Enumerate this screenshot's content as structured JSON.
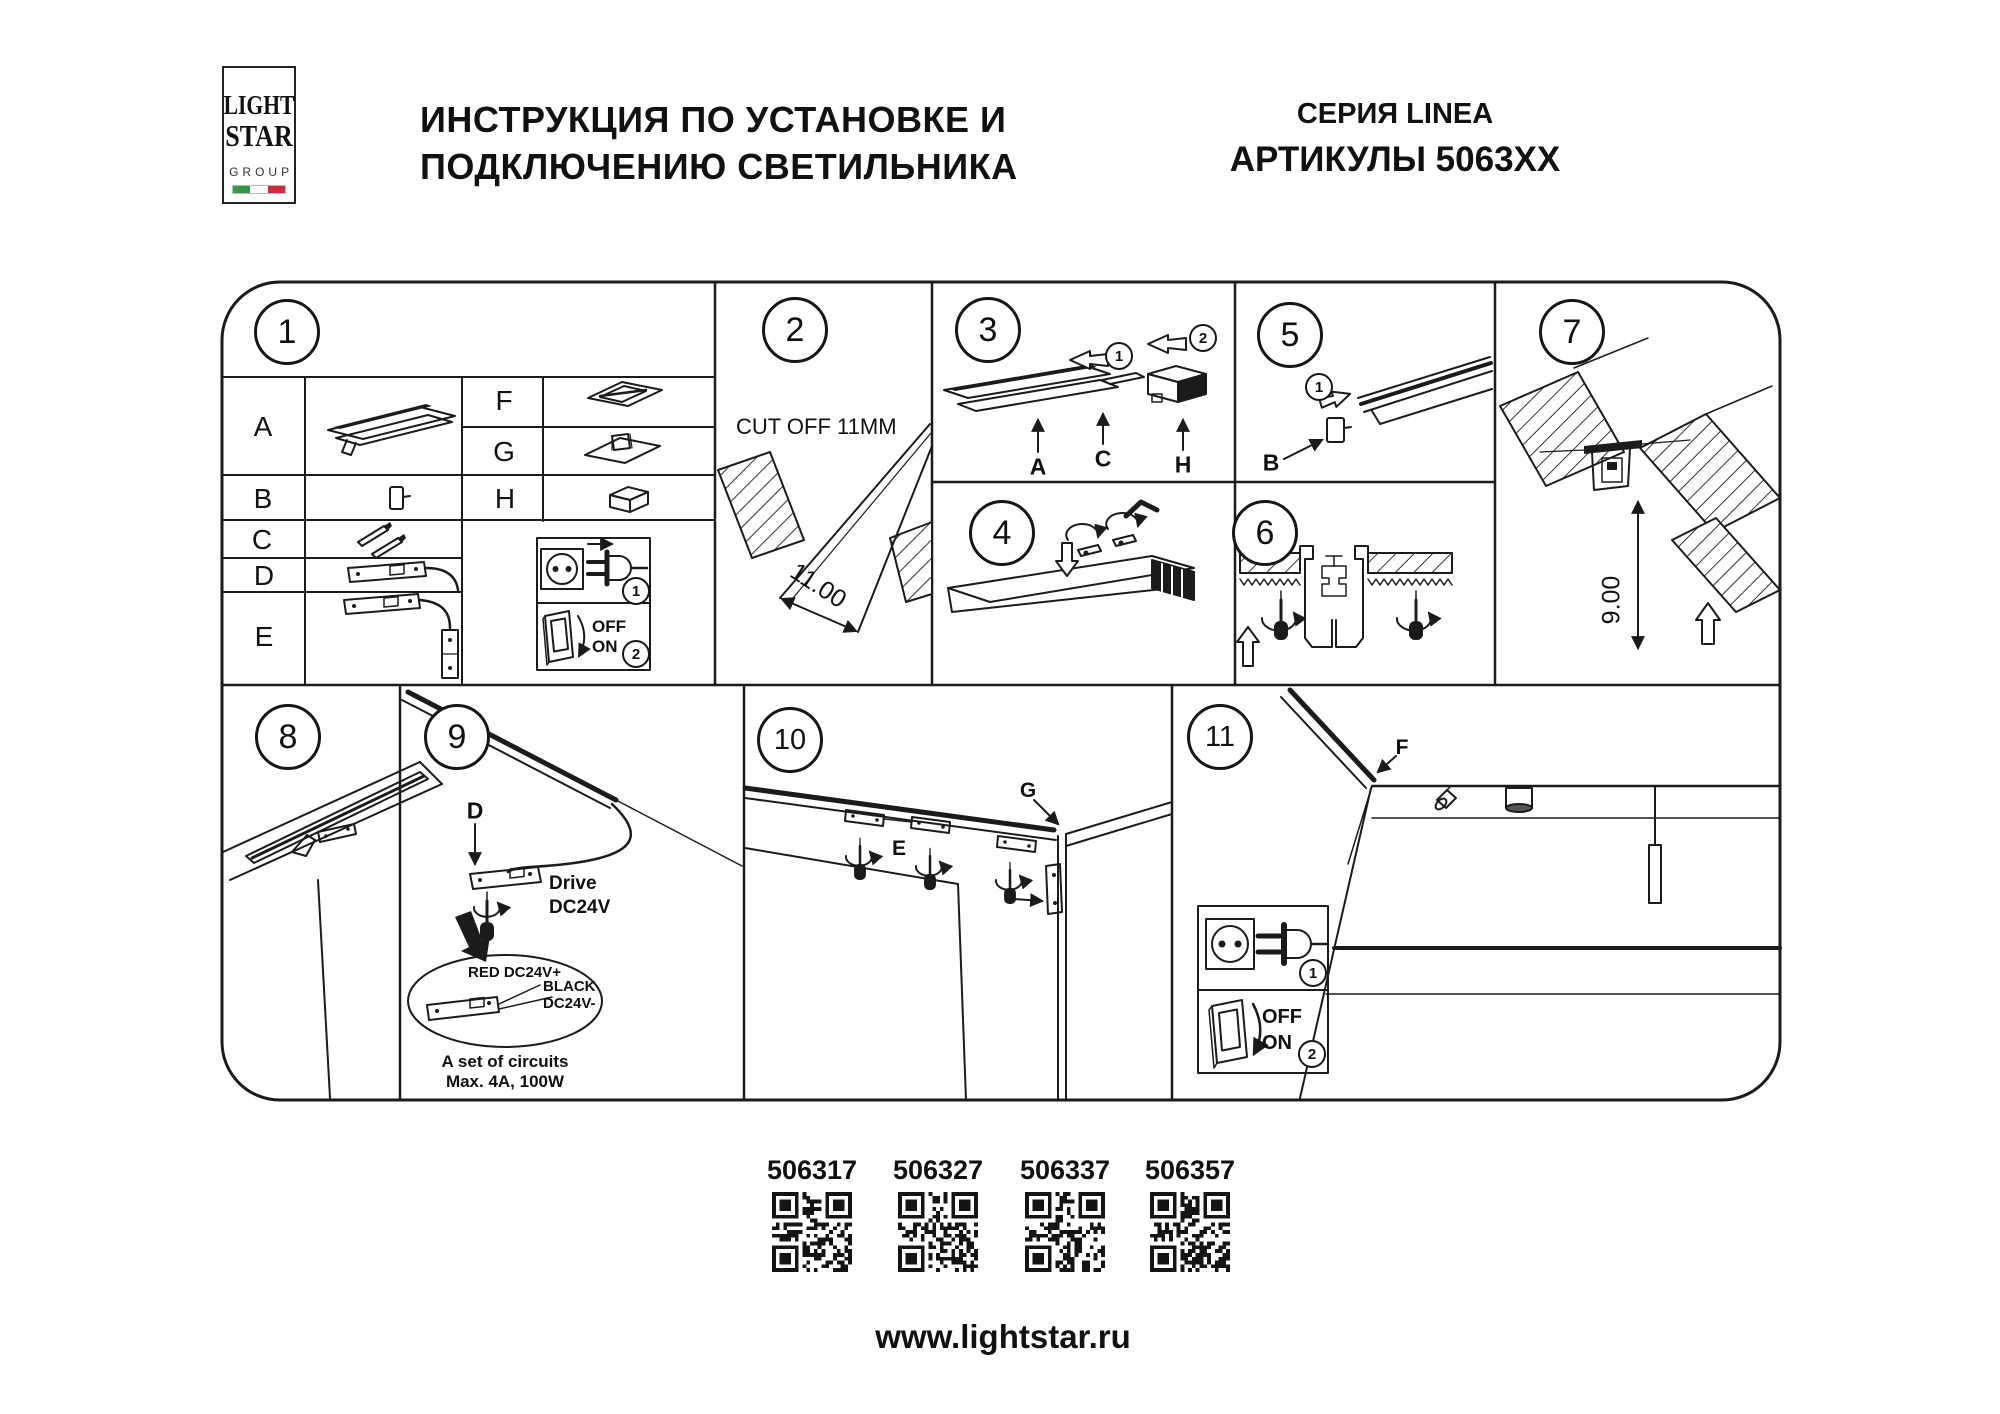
{
  "header": {
    "logo": {
      "word1": "LIGHT",
      "word2": "STAR",
      "word3": "GROUP",
      "flag_green": "#2e9a47",
      "flag_white": "#ffffff",
      "flag_red": "#ce2b37"
    },
    "title_line1": "ИНСТРУКЦИЯ ПО УСТАНОВКЕ И",
    "title_line2": "ПОДКЛЮЧЕНИЮ СВЕТИЛЬНИКА",
    "series": "СЕРИЯ LINEA",
    "articles": "АРТИКУЛЫ 5063XX"
  },
  "panels": {
    "p1": {
      "number": "1",
      "left_rows": [
        "A",
        "B",
        "C",
        "D",
        "E"
      ],
      "right_rows": [
        "F",
        "G",
        "H"
      ],
      "legend": {
        "step1": "1",
        "step2": "2",
        "off": "OFF",
        "on": "ON"
      }
    },
    "p2": {
      "number": "2",
      "cut_label": "CUT OFF 11MM",
      "dimension": "11.00"
    },
    "p3": {
      "number": "3",
      "step1": "1",
      "step2": "2",
      "label_a": "A",
      "label_c": "C",
      "label_h": "H"
    },
    "p4": {
      "number": "4"
    },
    "p5": {
      "number": "5",
      "step1": "1",
      "label_b": "B"
    },
    "p6": {
      "number": "6"
    },
    "p7": {
      "number": "7",
      "dimension": "9.00"
    },
    "p8": {
      "number": "8"
    },
    "p9": {
      "number": "9",
      "label_d": "D",
      "drive_line1": "Drive",
      "drive_line2": "DC24V",
      "wire_red": "RED DC24V+",
      "wire_black_line1": "BLACK",
      "wire_black_line2": "DC24V-",
      "circuits_line1": "A set of circuits",
      "circuits_line2": "Max. 4A, 100W"
    },
    "p10": {
      "number": "10",
      "label_e": "E",
      "label_g": "G"
    },
    "p11": {
      "number": "11",
      "label_f": "F",
      "legend": {
        "step1": "1",
        "step2": "2",
        "off": "OFF",
        "on": "ON"
      }
    }
  },
  "footer": {
    "qr_items": [
      {
        "code": "506317"
      },
      {
        "code": "506327"
      },
      {
        "code": "506337"
      },
      {
        "code": "506357"
      }
    ],
    "website": "www.lightstar.ru"
  }
}
